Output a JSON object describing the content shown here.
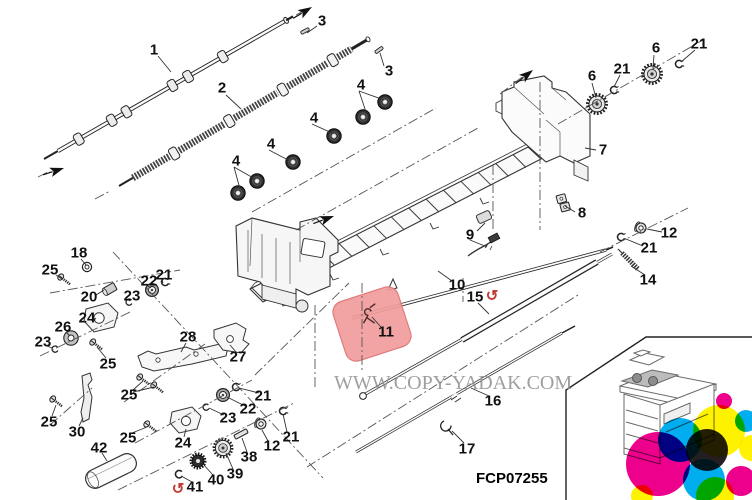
{
  "figure": {
    "code": "FCP07255",
    "watermark": "WWW.COPY-YADAK.COM"
  },
  "icons": {
    "rotate_cw": "↺"
  },
  "colors": {
    "highlight_fill": "#F19B9B",
    "highlight_border": "#E07B7B",
    "rotate_arrow": "#C23B33",
    "line": "#222222",
    "watermark_gray": "#8F8F8F",
    "logo_cyan": "#00AEEF",
    "logo_magenta": "#EC008C",
    "logo_yellow": "#FFF200",
    "logo_black": "#231F20"
  },
  "callouts": [
    "1",
    "2",
    "3",
    "3",
    "4",
    "4",
    "4",
    "4",
    "6",
    "21",
    "6",
    "21",
    "7",
    "8",
    "9",
    "12",
    "21",
    "14",
    "10",
    "15",
    "11",
    "16",
    "17",
    "18",
    "25",
    "20",
    "21",
    "22",
    "23",
    "24",
    "26",
    "23",
    "28",
    "27",
    "25",
    "25",
    "21",
    "22",
    "23",
    "25",
    "30",
    "21",
    "25",
    "24",
    "12",
    "42",
    "38",
    "39",
    "40",
    "41"
  ]
}
